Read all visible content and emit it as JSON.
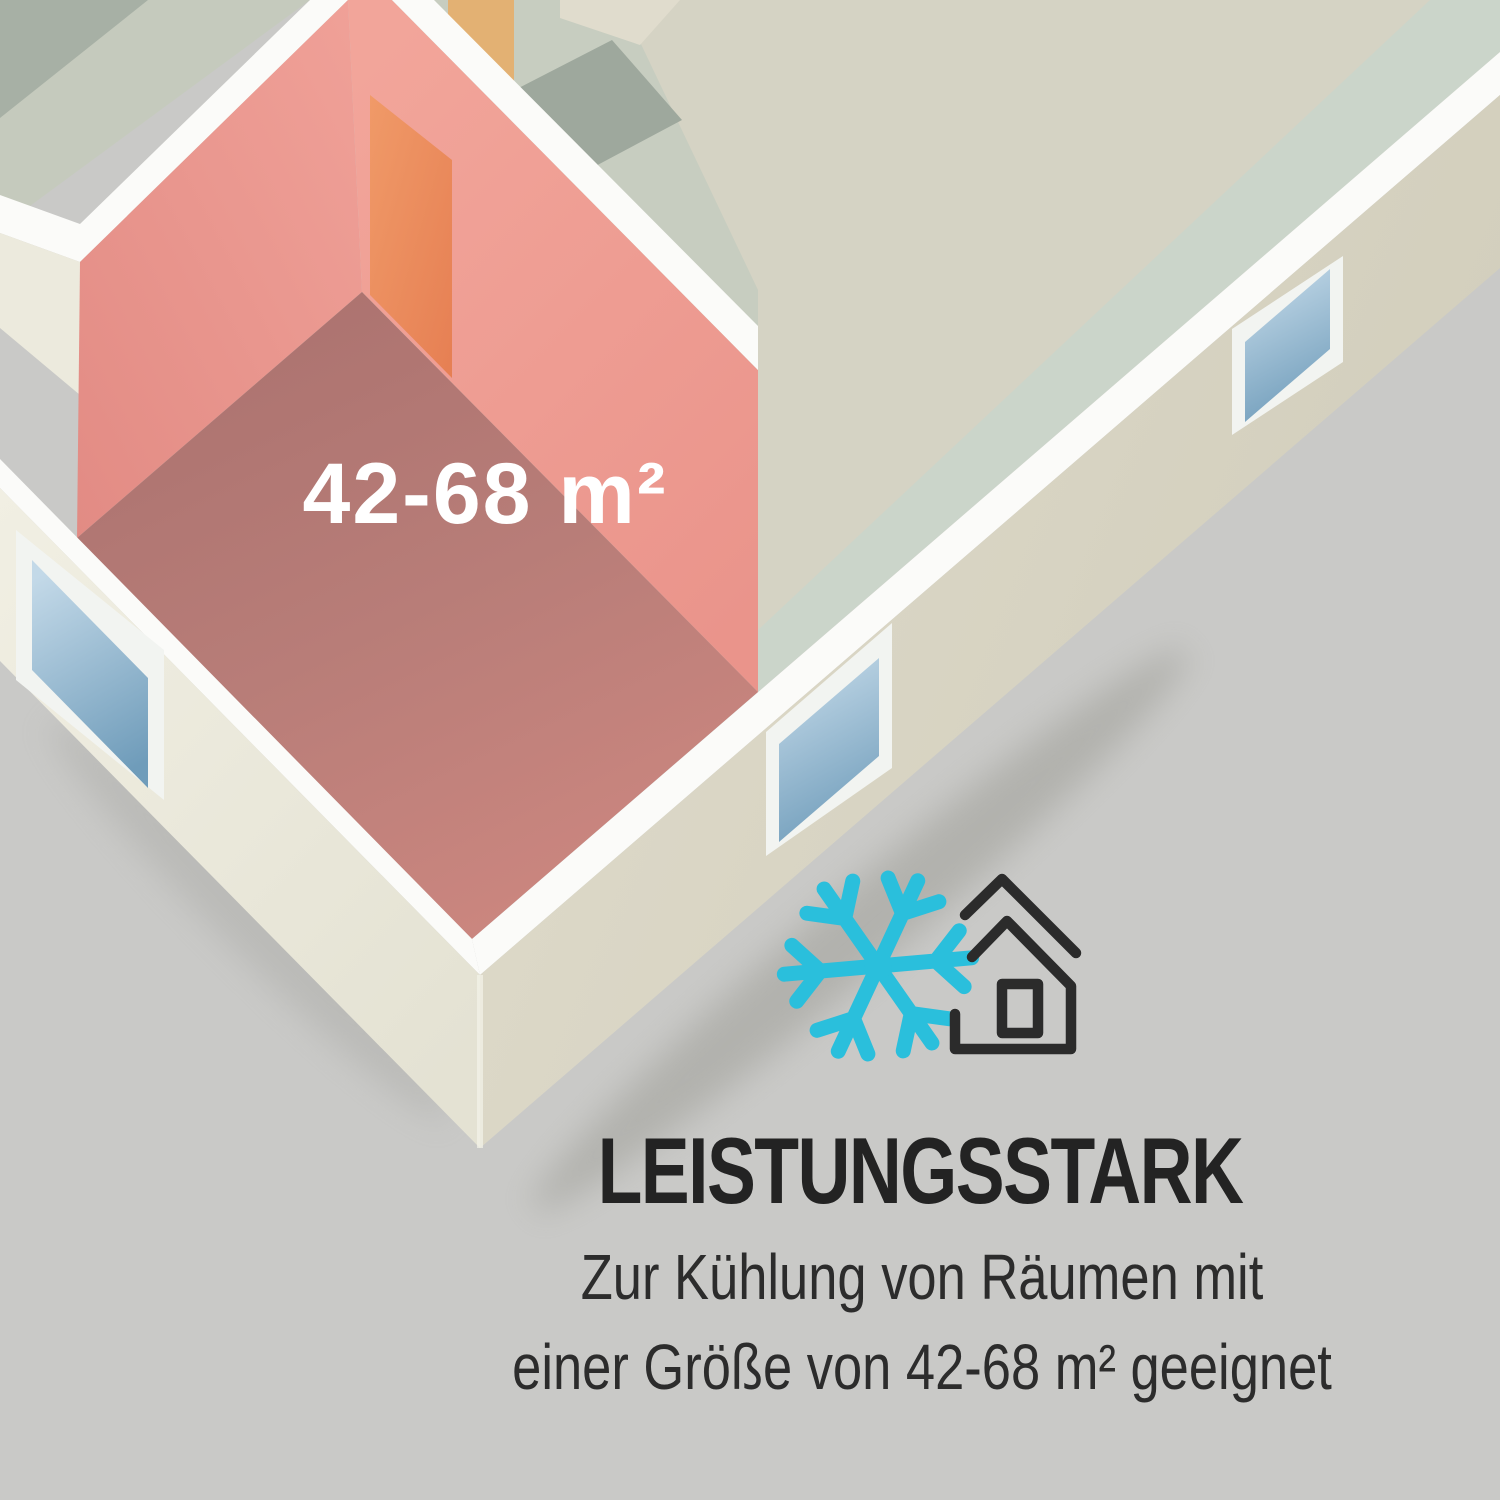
{
  "floorplan": {
    "room_label": "42-68 m²",
    "highlight_wall_color": "#ec988f",
    "highlight_floor_color": "#b87d78",
    "door_color": "#ec9161",
    "upper_door_color": "#e3b173",
    "wall_top_color": "#fbfbf9",
    "exterior_wall_shadow_color": "#d5d1c0",
    "exterior_wall_light_color": "#efede1",
    "sage_floor_color": "#c5cabd",
    "sage_floor_dark_color": "#a7b0a5",
    "beige_floor_color": "#d5d3c4",
    "green_strip_color": "#cbd5ca",
    "window_glass_top_color": "#c3d9e8",
    "window_glass_bottom_color": "#6f9cba",
    "window_frame_color": "#f2f4f1"
  },
  "icons": {
    "snowflake": "snowflake-icon",
    "snowflake_color": "#2abfdc",
    "house": "house-outline-icon",
    "house_color": "#2b2b2b"
  },
  "text": {
    "heading": "LEISTUNGSSTARK",
    "body_line1": "Zur Kühlung von Räumen mit",
    "body_line2": "einer Größe von 42-68 m² geeignet",
    "heading_color": "#232323",
    "body_color": "#2c2c2c"
  },
  "background_color": "#c9c9c7"
}
